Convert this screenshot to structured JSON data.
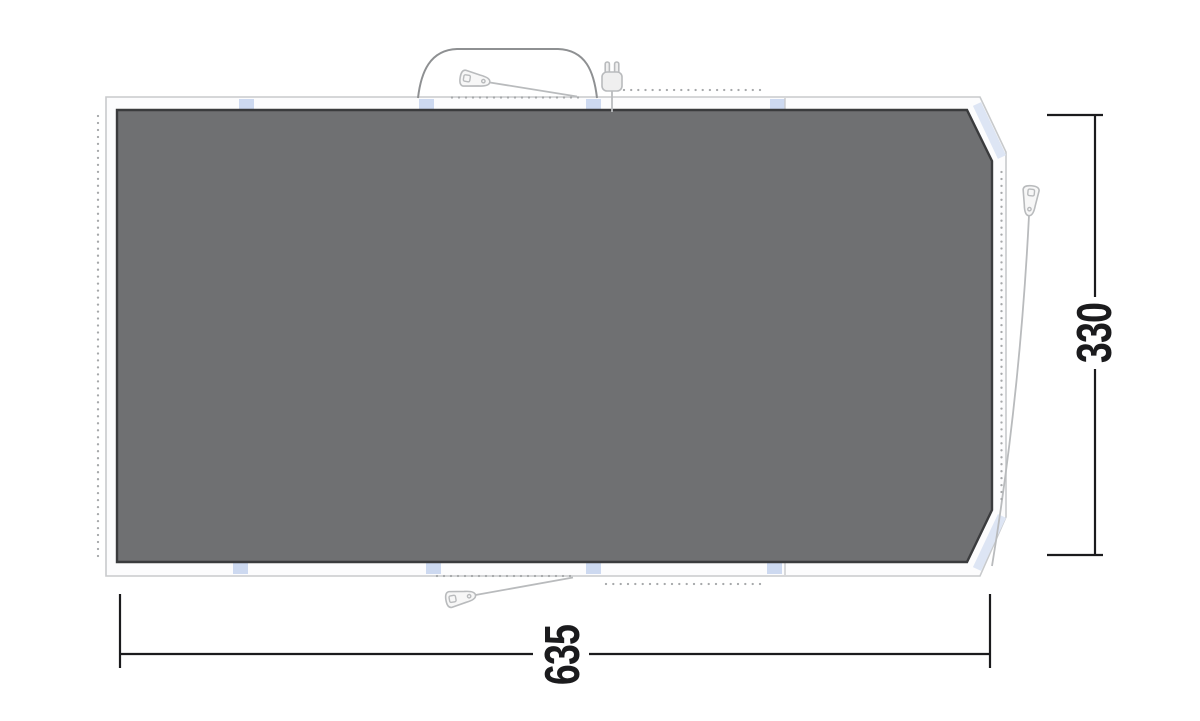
{
  "diagram": {
    "type": "tent-footprint-floorplan",
    "dimensions": {
      "width_label": "635",
      "height_label": "330"
    },
    "icons": {
      "top_peg": "guyline-peg-slider-icon",
      "bottom_peg": "guyline-peg-slider-icon",
      "right_peg": "guyline-peg-slider-icon",
      "plug": "power-plug-icon"
    },
    "colors": {
      "floor_fill": "#6f7072",
      "floor_border": "#3a3b3d",
      "groundsheet_fill": "#fcfcfd",
      "groundsheet_border": "#c8cacc",
      "tab_blue": "#cdd9f0",
      "webbing_blue": "#dde5f4",
      "canopy_gray": "#8e9092",
      "hardware_gray": "#b9bbbd",
      "dot_gray": "#a6a8aa",
      "dimension_black": "#1b1b1d"
    }
  }
}
